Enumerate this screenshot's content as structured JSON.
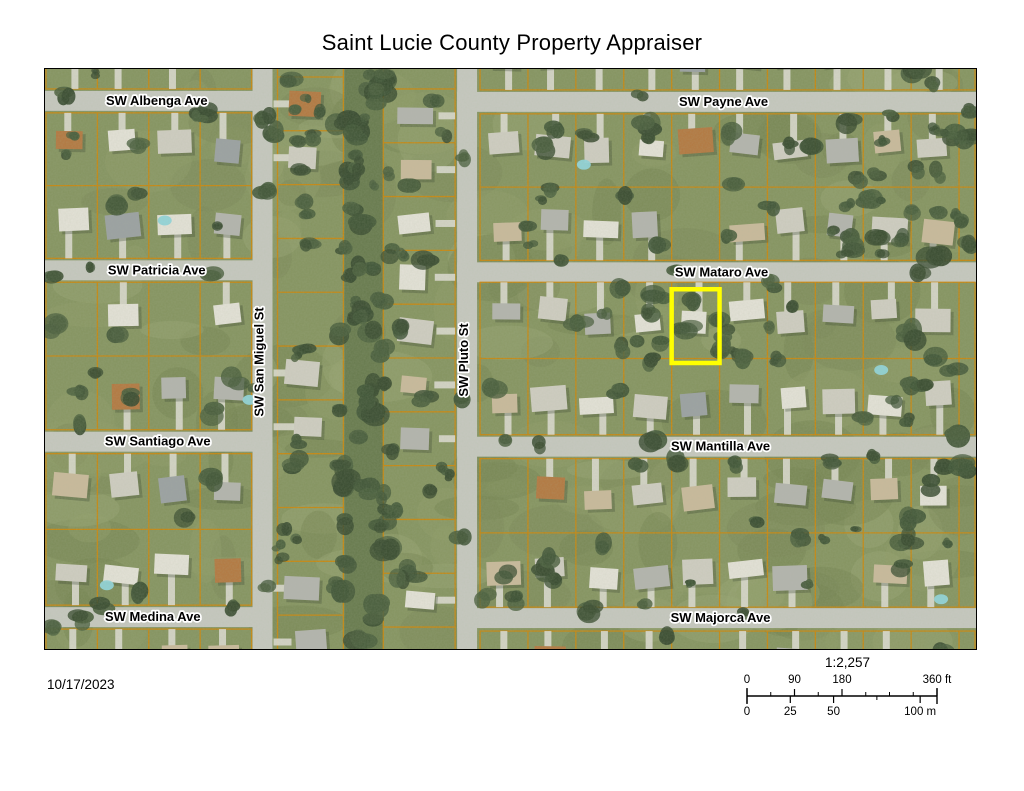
{
  "title": "Saint Lucie County Property Appraiser",
  "date": "10/17/2023",
  "scalebar": {
    "ratio": "1:2,257",
    "ft_total": 360,
    "m_total": 100,
    "ft_labels": [
      {
        "text": "0",
        "ft": 0
      },
      {
        "text": "90",
        "ft": 90
      },
      {
        "text": "180",
        "ft": 180
      },
      {
        "text": "360 ft",
        "ft": 360
      }
    ],
    "ft_minor_ticks": [
      45,
      135,
      225,
      270,
      315
    ],
    "m_labels": [
      {
        "text": "0",
        "m": 0
      },
      {
        "text": "25",
        "m": 25
      },
      {
        "text": "50",
        "m": 50
      },
      {
        "text": "100 m",
        "m": 100
      }
    ],
    "m_minor_ticks": [
      75
    ]
  },
  "map": {
    "streets": [
      {
        "id": "sw-albenga-ave",
        "name": "SW Albenga Ave",
        "x": 112,
        "y": 36,
        "angle": 0
      },
      {
        "id": "sw-payne-ave",
        "name": "SW Payne Ave",
        "x": 680,
        "y": 37,
        "angle": 0
      },
      {
        "id": "sw-patricia-ave",
        "name": "SW Patricia Ave",
        "x": 112,
        "y": 206,
        "angle": 0
      },
      {
        "id": "sw-mataro-ave",
        "name": "SW Mataro Ave",
        "x": 678,
        "y": 208,
        "angle": 0
      },
      {
        "id": "sw-san-miguel-st",
        "name": "SW San Miguel St",
        "x": 219,
        "y": 294,
        "angle": -90
      },
      {
        "id": "sw-pluto-st",
        "name": "SW Pluto St",
        "x": 424,
        "y": 292,
        "angle": -90
      },
      {
        "id": "sw-santiago-ave",
        "name": "SW Santiago Ave",
        "x": 113,
        "y": 378,
        "angle": 0
      },
      {
        "id": "sw-mantilla-ave",
        "name": "SW Mantilla Ave",
        "x": 677,
        "y": 383,
        "angle": 0
      },
      {
        "id": "sw-medina-ave",
        "name": "SW Medina Ave",
        "x": 108,
        "y": 554,
        "angle": 0
      },
      {
        "id": "sw-majorca-ave",
        "name": "SW Majorca Ave",
        "x": 677,
        "y": 555,
        "angle": 0
      }
    ],
    "highlight": {
      "x": 628,
      "y": 221,
      "w": 48,
      "h": 74,
      "color": "#ffff00"
    },
    "colors": {
      "grass": "#84935f",
      "grass_light": "#97a571",
      "grass_dark": "#73824f",
      "tree": "#3e5335",
      "canal": "#66794c",
      "road": "#c6c8c0",
      "driveway": "#dbdad0",
      "parcel_line": "#c9860b",
      "highlight": "#ffff00"
    }
  }
}
